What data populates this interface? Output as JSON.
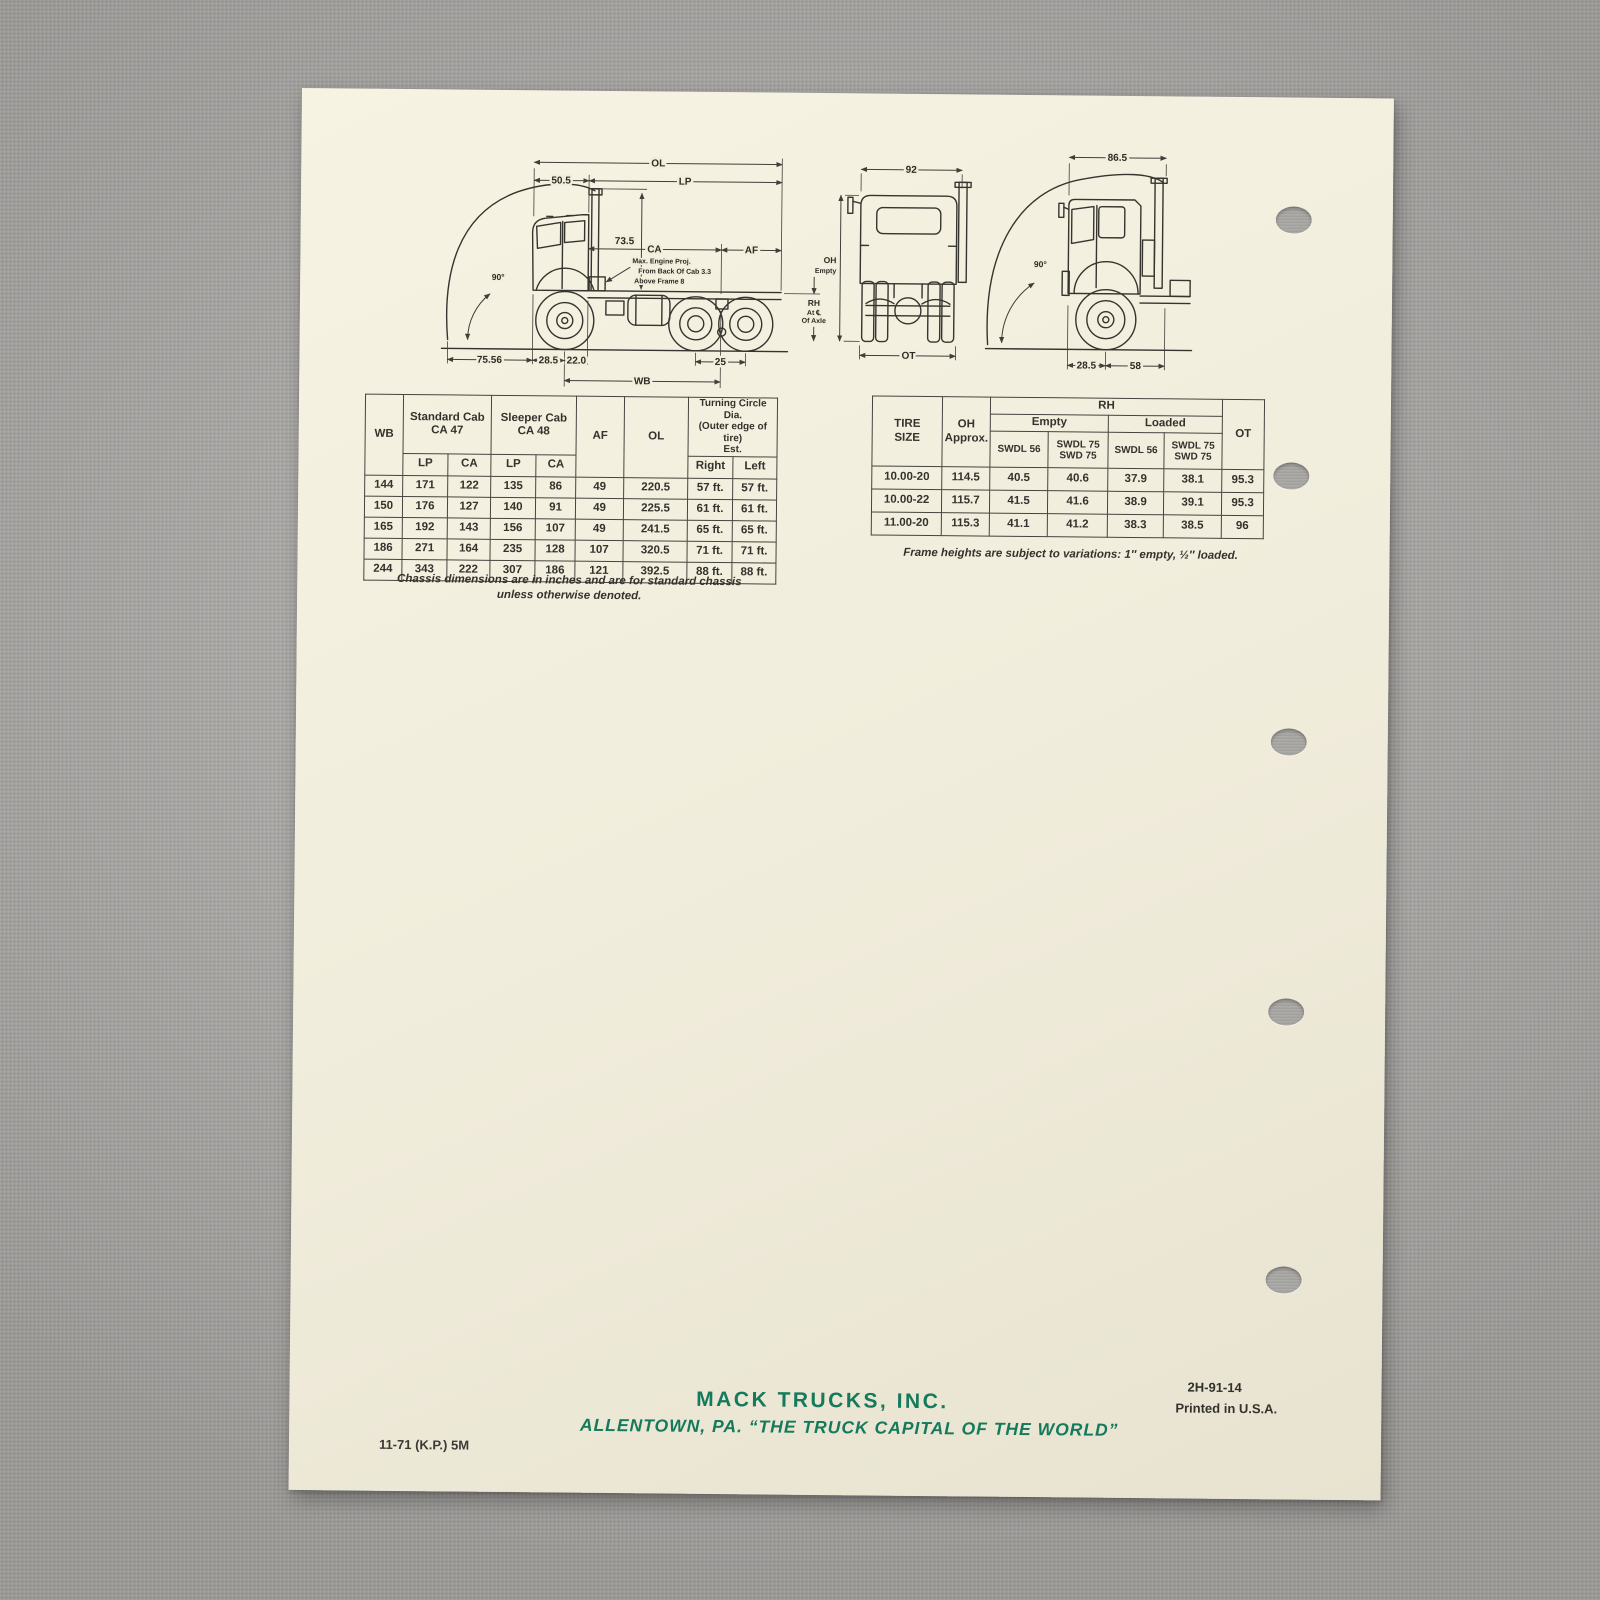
{
  "photo": {
    "background_hex": "#afadaa",
    "paper_hex": "#f2eedb",
    "accent_green_hex": "#157a5b",
    "ink_hex": "#33322c"
  },
  "diagram": {
    "side": {
      "ol": "OL",
      "lp": "LP",
      "front_overhang": "50.5",
      "stack_height": "73.5",
      "ca": "CA",
      "af": "AF",
      "tilt_angle": "90°",
      "engine_note_line1": "Max. Engine Proj.",
      "engine_note_line2": "From Back Of Cab 3.3",
      "engine_note_line3": "Above Frame 8",
      "tilt_radius": "75.56",
      "bumper_to_axle": "28.5",
      "axle_to_cab": "22.0",
      "tandem_spread": "25",
      "wb": "WB",
      "rh": "RH",
      "rh_line2": "At ℄",
      "rh_line3": "Of Axle"
    },
    "rear": {
      "cab_width": "92",
      "oh": "OH",
      "oh_line2": "Empty",
      "ot": "OT"
    },
    "tilt": {
      "tilt_clearance": "86.5",
      "tilt_angle": "90°",
      "bumper_to_axle": "28.5",
      "axle_to_back": "58"
    }
  },
  "dims_table": {
    "h_wb": "WB",
    "h_std_cab": "Standard Cab",
    "h_std_ca": "CA 47",
    "h_slp_cab": "Sleeper Cab",
    "h_slp_ca": "CA 48",
    "h_lp1": "LP",
    "h_ca1": "CA",
    "h_lp2": "LP",
    "h_ca2": "CA",
    "h_af": "AF",
    "h_ol": "OL",
    "h_turn1": "Turning Circle Dia.",
    "h_turn2": "(Outer edge of tire)",
    "h_turn3": "Est.",
    "h_right": "Right",
    "h_left": "Left",
    "rows": [
      [
        "144",
        "171",
        "122",
        "135",
        "86",
        "49",
        "220.5",
        "57 ft.",
        "57 ft."
      ],
      [
        "150",
        "176",
        "127",
        "140",
        "91",
        "49",
        "225.5",
        "61 ft.",
        "61 ft."
      ],
      [
        "165",
        "192",
        "143",
        "156",
        "107",
        "49",
        "241.5",
        "65 ft.",
        "65 ft."
      ],
      [
        "186",
        "271",
        "164",
        "235",
        "128",
        "107",
        "320.5",
        "71 ft.",
        "71 ft."
      ],
      [
        "244",
        "343",
        "222",
        "307",
        "186",
        "121",
        "392.5",
        "88 ft.",
        "88 ft."
      ]
    ],
    "note1": "Chassis dimensions are in inches and are for standard chassis",
    "note2": "unless otherwise denoted."
  },
  "tire_table": {
    "h_tire1": "TIRE",
    "h_tire2": "SIZE",
    "h_oh1": "OH",
    "h_oh2": "Approx.",
    "h_rh": "RH",
    "h_empty": "Empty",
    "h_loaded": "Loaded",
    "h_swdl56_a": "SWDL 56",
    "h_swdl75_a1": "SWDL 75",
    "h_swdl75_a2": "SWD  75",
    "h_swdl56_b": "SWDL 56",
    "h_swdl75_b1": "SWDL 75",
    "h_swdl75_b2": "SWD  75",
    "h_ot": "OT",
    "rows": [
      [
        "10.00-20",
        "114.5",
        "40.5",
        "40.6",
        "37.9",
        "38.1",
        "95.3"
      ],
      [
        "10.00-22",
        "115.7",
        "41.5",
        "41.6",
        "38.9",
        "39.1",
        "95.3"
      ],
      [
        "11.00-20",
        "115.3",
        "41.1",
        "41.2",
        "38.3",
        "38.5",
        "96"
      ]
    ],
    "note": "Frame heights are subject to variations: 1″ empty, ½″ loaded."
  },
  "footer": {
    "company": "MACK TRUCKS, INC.",
    "tagline": "ALLENTOWN, PA. “THE TRUCK CAPITAL OF THE WORLD”",
    "run_code": "11-71 (K.P.) 5M",
    "form_number": "2H-91-14",
    "printed": "Printed in U.S.A."
  }
}
